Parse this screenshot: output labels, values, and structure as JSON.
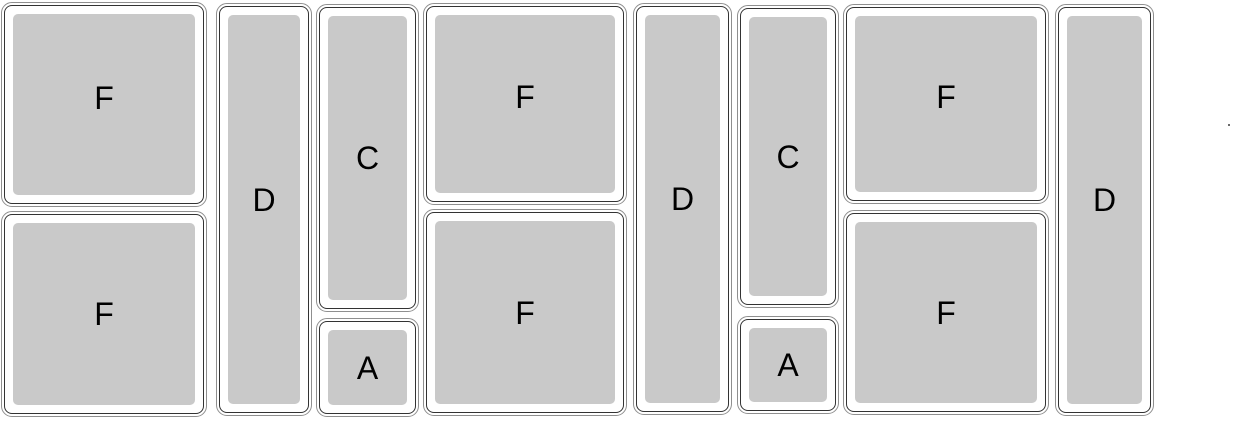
{
  "diagram": {
    "description": "Layout diagram of rounded rectangular bins/pans arranged in columns, each labeled with a size letter",
    "colors": {
      "background": "#ffffff",
      "pan_fill": "#c9c9c9",
      "outer_stroke": "#8f8f8f",
      "inner_stroke": "#333333",
      "label_color": "#000000"
    },
    "columns": [
      {
        "pans": [
          {
            "label": "F"
          },
          {
            "label": "F"
          }
        ]
      },
      {
        "pans": [
          {
            "label": "D"
          }
        ]
      },
      {
        "pans": [
          {
            "label": "C"
          },
          {
            "label": "A"
          }
        ]
      },
      {
        "pans": [
          {
            "label": "F"
          },
          {
            "label": "F"
          }
        ]
      },
      {
        "pans": [
          {
            "label": "D"
          }
        ]
      },
      {
        "pans": [
          {
            "label": "C"
          },
          {
            "label": "A"
          }
        ]
      },
      {
        "pans": [
          {
            "label": "F"
          },
          {
            "label": "F"
          }
        ]
      },
      {
        "pans": [
          {
            "label": "D"
          }
        ]
      }
    ],
    "stray_mark": "tiny dark dot near right edge"
  }
}
